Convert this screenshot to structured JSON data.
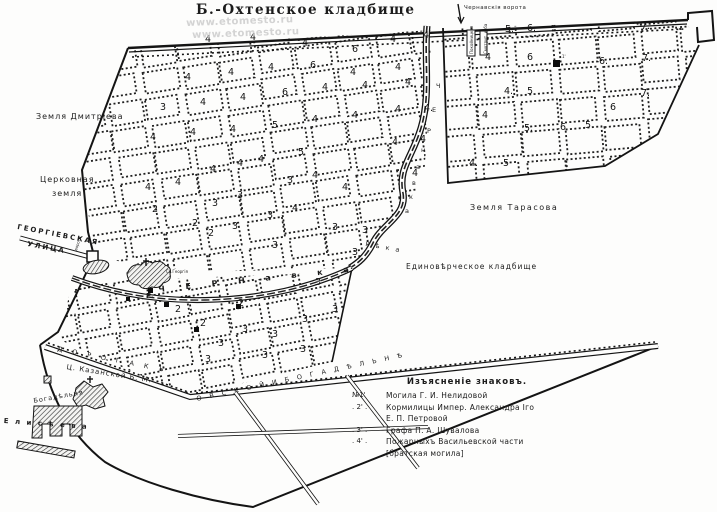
{
  "title": "Б.-Охтенское  кладбище",
  "watermark": {
    "line1": "www.etomesto.ru",
    "line2": "www.etomesto.ru"
  },
  "areas": {
    "dmitrieva": "Земля Дмитріева",
    "tserkovnaya1": "Церковная",
    "tserkovnaya2": "земля",
    "tarasova": "Земля Тарасова",
    "edinovercheskoe": "Единовѣрческое кладбище"
  },
  "streets": {
    "georgievskaya1": "ГЕОРГІЕВСКАЯ",
    "georgievskaya2": "УЛИЦА",
    "gate_small": "ворота",
    "chernavka_prefix": "Р.",
    "chernavka_street": "Ч Е Р Н а в к а",
    "road_left": "Д О Р О Г А   К Ъ",
    "road_main": "О В С К О Й    И    Б О Г А Д Ѣ Л Ь Н Ѣ",
    "reka": "Р ѣ к а",
    "reka_letters": [
      "Ч",
      "Е",
      "Р",
      "н",
      "а",
      "в",
      "к",
      "а"
    ]
  },
  "gates": {
    "chernavskie": "Чернавскія ворота"
  },
  "buildings": {
    "st_george": "Св.Георгія",
    "kazan": "Ц. Казанской Б. М.",
    "bogadelnya": "Богадѣльня",
    "eliseeva": "Е л и с ѣ е в а",
    "morgue": "Покойницкая",
    "keeper": "Смотрит. изба"
  },
  "markers": {
    "grave1": "1'"
  },
  "legend": {
    "header": "Изъясненіе знаковъ.",
    "rows": [
      {
        "marker": "№1'",
        "text": "Могила Г. И. Нелидовой"
      },
      {
        "marker": ".  2'   .",
        "text": "Кормилицы Импер. Александра Iго"
      },
      {
        "marker": "",
        "text": "Е. П. Петровой"
      },
      {
        "marker": ".  3'   .",
        "text": "Графа П. А. Шувалова"
      },
      {
        "marker": ".  4'   .",
        "text": "Пожарныхъ Васильевской части"
      },
      {
        "marker": "",
        "text": "[братская могила]"
      }
    ]
  },
  "block_numbers": [
    {
      "n": "4",
      "x": 205,
      "y": 42
    },
    {
      "n": "4",
      "x": 250,
      "y": 40
    },
    {
      "n": "4",
      "x": 302,
      "y": 46
    },
    {
      "n": "6",
      "x": 352,
      "y": 52
    },
    {
      "n": "4",
      "x": 390,
      "y": 42
    },
    {
      "n": "4",
      "x": 423,
      "y": 38
    },
    {
      "n": "4",
      "x": 185,
      "y": 80
    },
    {
      "n": "4",
      "x": 228,
      "y": 75
    },
    {
      "n": "4",
      "x": 268,
      "y": 70
    },
    {
      "n": "6",
      "x": 310,
      "y": 68
    },
    {
      "n": "4",
      "x": 350,
      "y": 75
    },
    {
      "n": "4",
      "x": 395,
      "y": 70
    },
    {
      "n": "3",
      "x": 160,
      "y": 110
    },
    {
      "n": "4",
      "x": 200,
      "y": 105
    },
    {
      "n": "4",
      "x": 240,
      "y": 100
    },
    {
      "n": "6",
      "x": 282,
      "y": 95
    },
    {
      "n": "4",
      "x": 322,
      "y": 90
    },
    {
      "n": "4",
      "x": 362,
      "y": 88
    },
    {
      "n": "4",
      "x": 405,
      "y": 85
    },
    {
      "n": "4",
      "x": 150,
      "y": 140
    },
    {
      "n": "4",
      "x": 190,
      "y": 135
    },
    {
      "n": "4",
      "x": 230,
      "y": 132
    },
    {
      "n": "5",
      "x": 272,
      "y": 128
    },
    {
      "n": "4",
      "x": 312,
      "y": 122
    },
    {
      "n": "4",
      "x": 352,
      "y": 118
    },
    {
      "n": "4",
      "x": 395,
      "y": 112
    },
    {
      "n": "4.",
      "x": 424,
      "y": 111
    },
    {
      "n": "4",
      "x": 145,
      "y": 190
    },
    {
      "n": "4",
      "x": 175,
      "y": 185
    },
    {
      "n": "4",
      "x": 210,
      "y": 172
    },
    {
      "n": "4",
      "x": 237,
      "y": 166
    },
    {
      "n": "4",
      "x": 258,
      "y": 162
    },
    {
      "n": "5",
      "x": 298,
      "y": 155
    },
    {
      "n": "3",
      "x": 287,
      "y": 183
    },
    {
      "n": "4",
      "x": 312,
      "y": 178
    },
    {
      "n": "4",
      "x": 342,
      "y": 190
    },
    {
      "n": "4",
      "x": 392,
      "y": 145
    },
    {
      "n": "4",
      "x": 420,
      "y": 142
    },
    {
      "n": "2",
      "x": 152,
      "y": 212
    },
    {
      "n": "2",
      "x": 192,
      "y": 226
    },
    {
      "n": "3",
      "x": 212,
      "y": 206
    },
    {
      "n": "3",
      "x": 237,
      "y": 198
    },
    {
      "n": "3",
      "x": 267,
      "y": 218
    },
    {
      "n": "4",
      "x": 292,
      "y": 211
    },
    {
      "n": "3",
      "x": 332,
      "y": 230
    },
    {
      "n": "3",
      "x": 362,
      "y": 233
    },
    {
      "n": "4",
      "x": 412,
      "y": 176
    },
    {
      "n": "2",
      "x": 208,
      "y": 236
    },
    {
      "n": "3",
      "x": 232,
      "y": 229
    },
    {
      "n": "3",
      "x": 272,
      "y": 248
    },
    {
      "n": "3",
      "x": 352,
      "y": 255
    },
    {
      "n": "2",
      "x": 175,
      "y": 312
    },
    {
      "n": "2",
      "x": 200,
      "y": 326
    },
    {
      "n": "3",
      "x": 218,
      "y": 346
    },
    {
      "n": "3",
      "x": 242,
      "y": 332
    },
    {
      "n": "3",
      "x": 272,
      "y": 337
    },
    {
      "n": "3",
      "x": 302,
      "y": 322
    },
    {
      "n": "3",
      "x": 332,
      "y": 312
    },
    {
      "n": "3",
      "x": 205,
      "y": 362
    },
    {
      "n": "3",
      "x": 262,
      "y": 358
    },
    {
      "n": "3",
      "x": 300,
      "y": 352
    },
    {
      "n": "2",
      "x": 238,
      "y": 306
    },
    {
      "n": "3",
      "x": 315,
      "y": 285
    },
    {
      "n": "5.",
      "x": 505,
      "y": 32
    },
    {
      "n": "6.",
      "x": 527,
      "y": 31
    },
    {
      "n": "7.",
      "x": 641,
      "y": 29
    },
    {
      "n": "4",
      "x": 485,
      "y": 60
    },
    {
      "n": "6",
      "x": 527,
      "y": 60
    },
    {
      "n": "6.",
      "x": 599,
      "y": 64
    },
    {
      "n": "7.",
      "x": 642,
      "y": 61
    },
    {
      "n": "4.",
      "x": 504,
      "y": 94
    },
    {
      "n": "5",
      "x": 527,
      "y": 94
    },
    {
      "n": "7.",
      "x": 641,
      "y": 96
    },
    {
      "n": "5.",
      "x": 524,
      "y": 131
    },
    {
      "n": "6",
      "x": 560,
      "y": 130
    },
    {
      "n": "4",
      "x": 482,
      "y": 118
    },
    {
      "n": "4.",
      "x": 469,
      "y": 166
    },
    {
      "n": "5",
      "x": 503,
      "y": 166
    },
    {
      "n": "5",
      "x": 585,
      "y": 128
    },
    {
      "n": "6",
      "x": 610,
      "y": 110
    }
  ]
}
